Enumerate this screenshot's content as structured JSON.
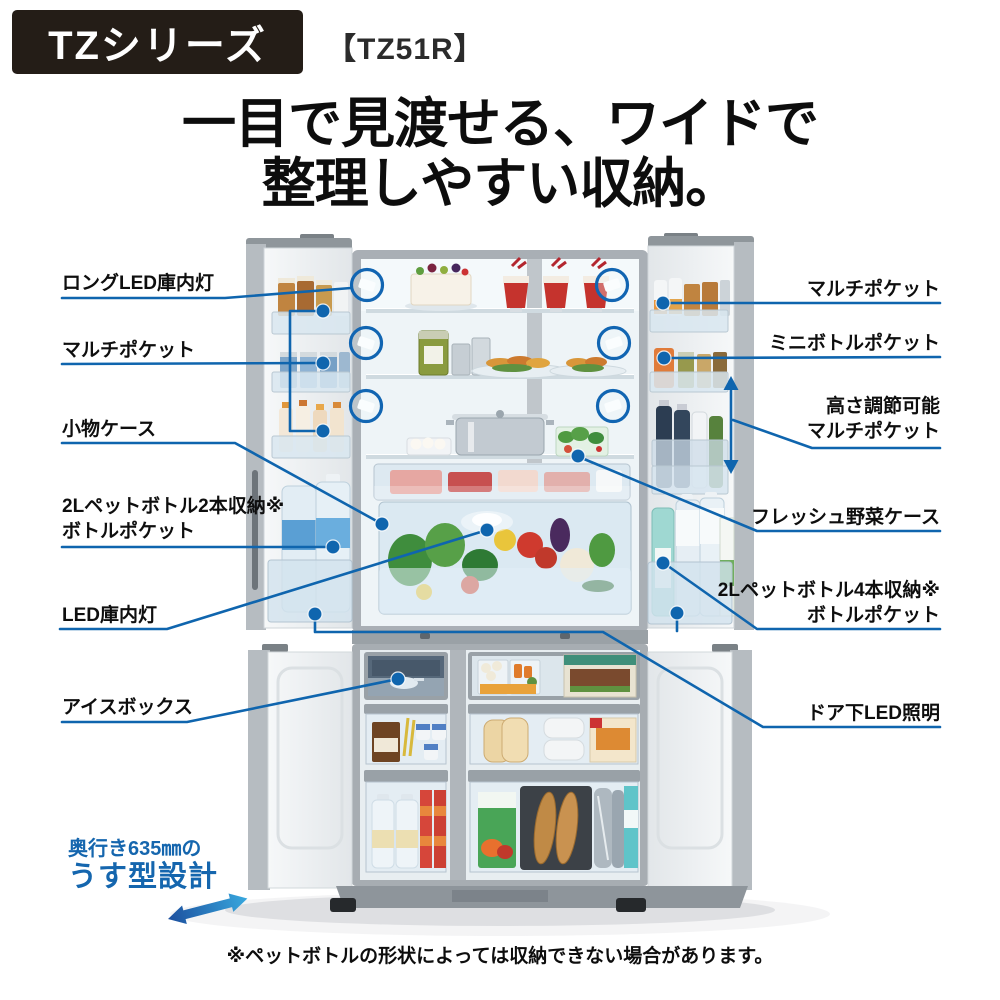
{
  "header": {
    "series_badge": "TZシリーズ",
    "model": "【TZ51R】"
  },
  "headline": {
    "line1": "一目で見渡せる、ワイドで",
    "line2": "整理しやすい収納。"
  },
  "callouts_left": [
    {
      "label": "ロングLED庫内灯"
    },
    {
      "label": "マルチポケット"
    },
    {
      "label": "小物ケース"
    },
    {
      "label": "2Lペットボトル2本収納※",
      "label2": "ボトルポケット"
    },
    {
      "label": "LED庫内灯"
    },
    {
      "label": "アイスボックス"
    }
  ],
  "callouts_right": [
    {
      "label": "マルチポケット"
    },
    {
      "label": "ミニボトルポケット"
    },
    {
      "label": "高さ調節可能",
      "label2": "マルチポケット"
    },
    {
      "label": "フレッシュ野菜ケース"
    },
    {
      "label": "2Lペットボトル4本収納※",
      "label2": "ボトルポケット"
    },
    {
      "label": "ドア下LED照明"
    }
  ],
  "slim_design": {
    "line1": "奥行き635㎜の",
    "line2": "うす型設計"
  },
  "footnote": "※ペットボトルの形状によっては収納できない場合があります。",
  "colors": {
    "callout_blue": "#0f65ae",
    "badge_background": "#241d17",
    "headline_text": "#0d0d0d",
    "slim_design_blue": "#1566ae"
  }
}
